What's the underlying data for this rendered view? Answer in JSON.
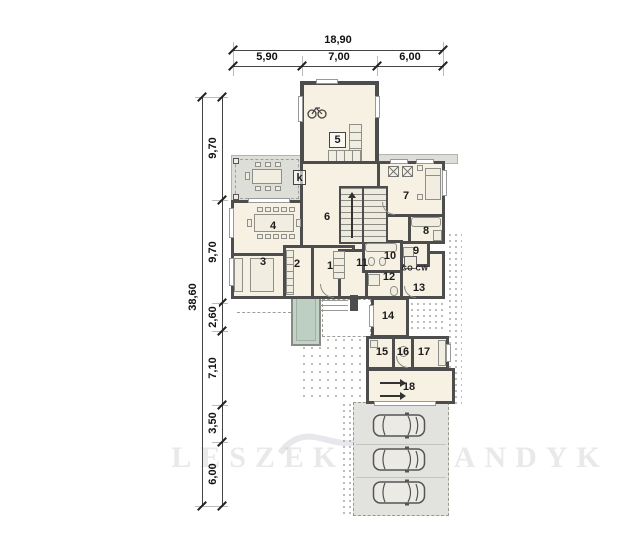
{
  "plan": {
    "type": "floor-plan",
    "watermark": "LESZEK KALANDYK",
    "dimensions": {
      "top": {
        "total": "18,90",
        "segments": [
          "5,90",
          "7,00",
          "6,00"
        ]
      },
      "left": {
        "total": "38,60",
        "segments": [
          "9,70",
          "9,70",
          "2,60",
          "7,10",
          "3,50",
          "6,00"
        ]
      }
    },
    "rooms": {
      "r1": "1",
      "r2": "2",
      "r3": "3",
      "r4": "4",
      "r5": "5",
      "r6": "6",
      "r7": "7",
      "r8": "8",
      "r9": "9",
      "r10": "10",
      "r11": "11",
      "r12": "12",
      "r13": "13",
      "r14": "14",
      "r15": "15",
      "r16": "16",
      "r17": "17",
      "r18": "18"
    },
    "annotations": {
      "fireplace": "k",
      "boiler": "CO CW"
    },
    "colors": {
      "wall": "#4d4d4d",
      "floor": "#f6f1e3",
      "paving": "#deded9",
      "pool": "#c2d2c6",
      "dimension_text": "#111111"
    }
  }
}
